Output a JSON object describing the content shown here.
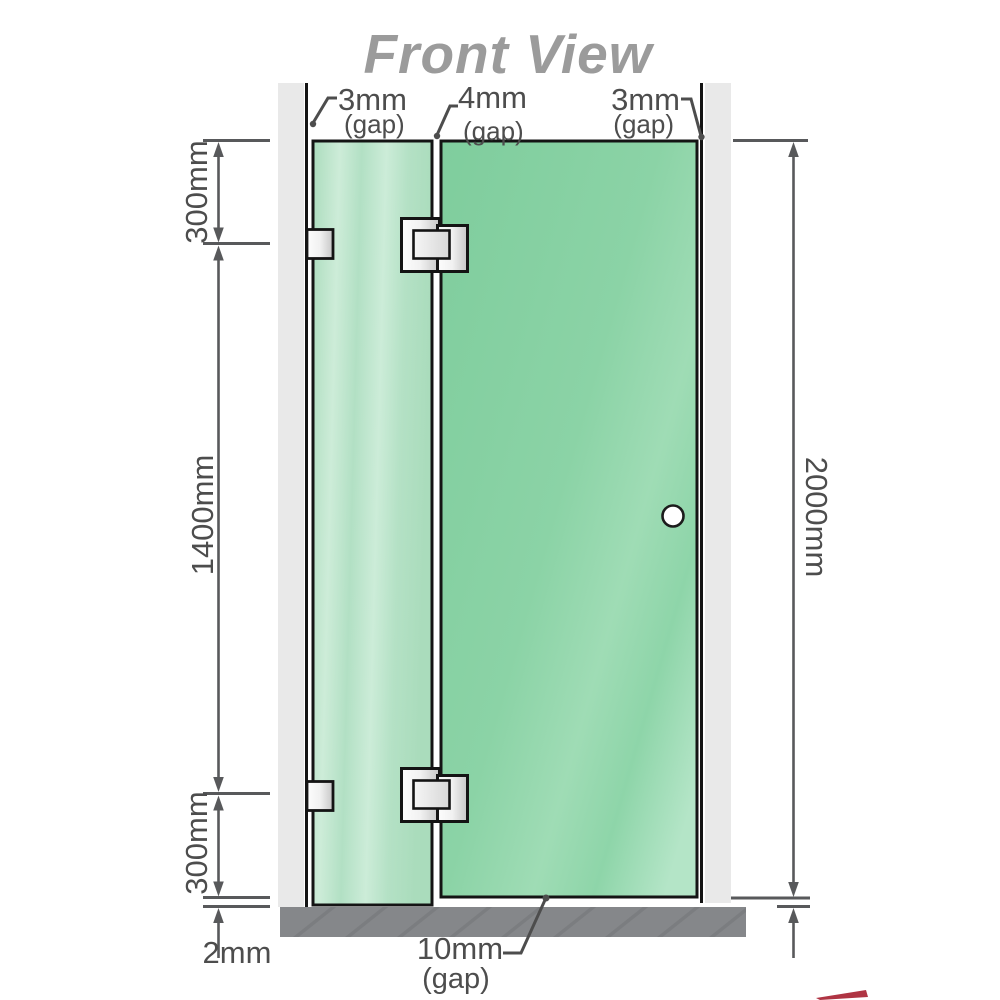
{
  "title": "Front View",
  "labels": {
    "top_left": {
      "value": "3mm",
      "unit": "(gap)"
    },
    "top_middle": {
      "value": "4mm",
      "unit": "(gap)"
    },
    "top_right": {
      "value": "3mm",
      "unit": "(gap)"
    },
    "bottom_middle": {
      "value": "10mm",
      "unit": "(gap)"
    },
    "bottom_left_gap": "2mm"
  },
  "dimensions": {
    "left_top": "300mm",
    "left_middle": "1400mm",
    "left_bottom": "300mm",
    "right_total": "2000mm"
  },
  "colors": {
    "title_gray": "#9b9b9b",
    "label_gray": "#4d4d4d",
    "dimension_gray": "#58595b",
    "wall_gray": "#e9e9e9",
    "floor_gray": "#85878a",
    "glass_left_green": "#b7e3c6",
    "glass_right_green": "#8bd3a6",
    "hinge_metal": "#e3e3e3",
    "outline_black": "#141414",
    "accent_red": "#a11022"
  }
}
